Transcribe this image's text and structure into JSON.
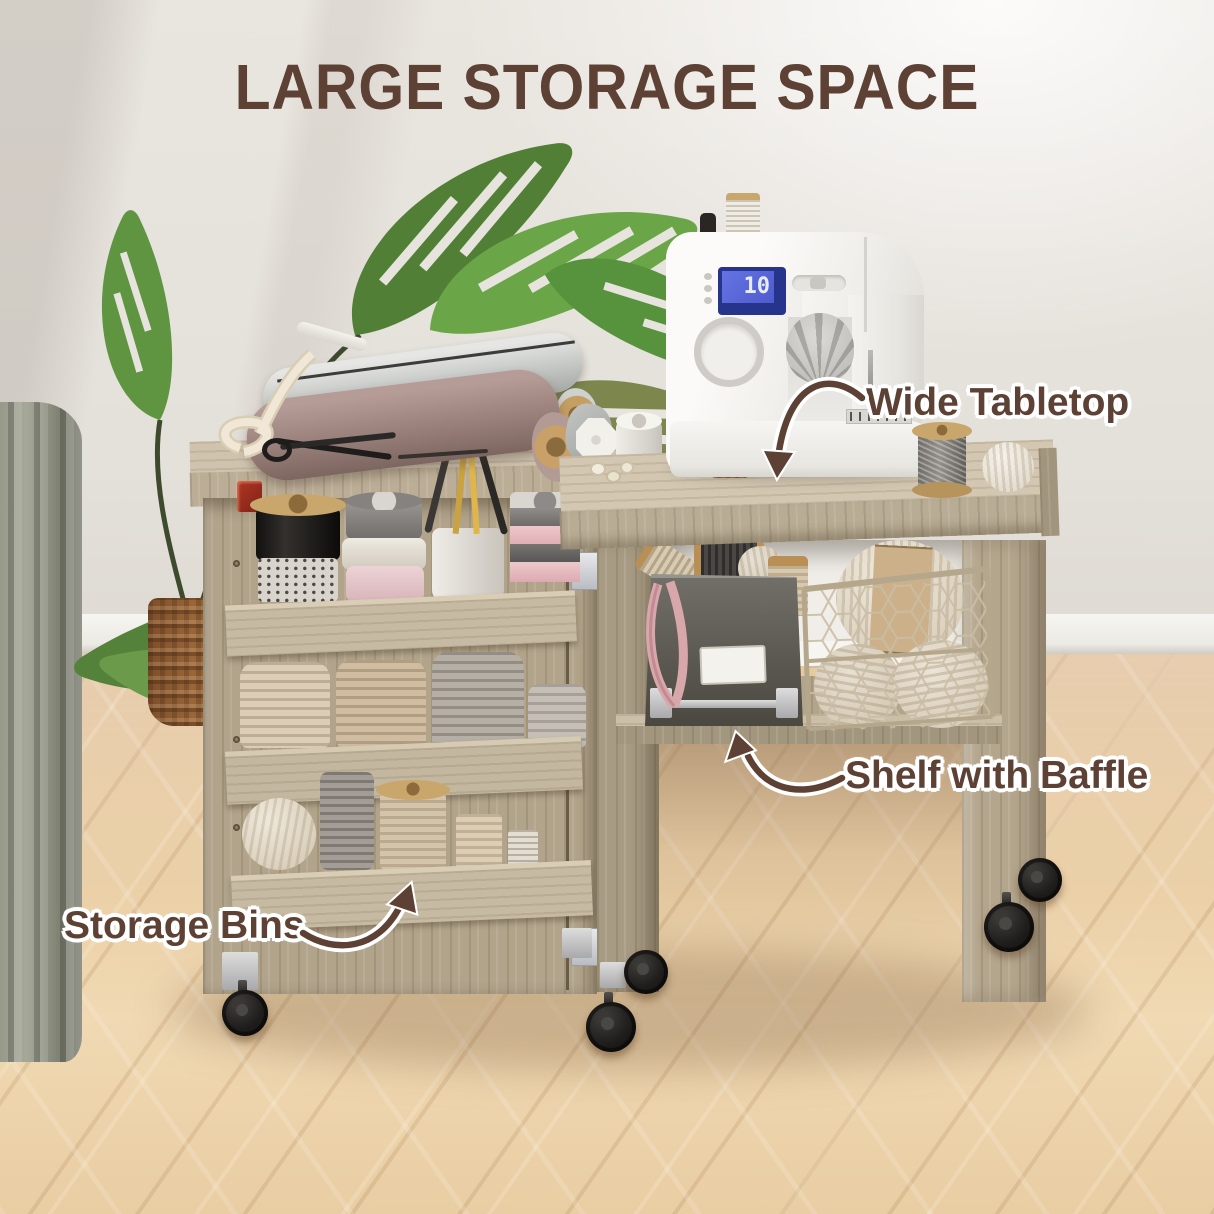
{
  "title": {
    "text": "LARGE STORAGE SPACE",
    "color": "#5d4134"
  },
  "callouts": [
    {
      "id": "wide-tabletop",
      "label": "Wide Tabletop"
    },
    {
      "id": "shelf-with-baffle",
      "label": "Shelf with Baffle"
    },
    {
      "id": "storage-bins",
      "label": "Storage Bins"
    }
  ],
  "sewing_machine": {
    "lcd_text": "10"
  },
  "palette": {
    "text_brown": "#5d4134",
    "outline_white": "#ffffff",
    "wall": "#e7e3dd",
    "floor_light": "#f0d9b3",
    "floor_dark": "#ddb88c",
    "cart_wood": "#b3a58c",
    "tabletop_wood": "#d2c6b1",
    "machine_white": "#f8f7f4",
    "lcd_blue": "#5a68d8",
    "bin_gray": "#57554f",
    "plant_green": "#5f9440",
    "caster_black": "#1b1a19",
    "wicker_brown": "#8a5a33"
  }
}
